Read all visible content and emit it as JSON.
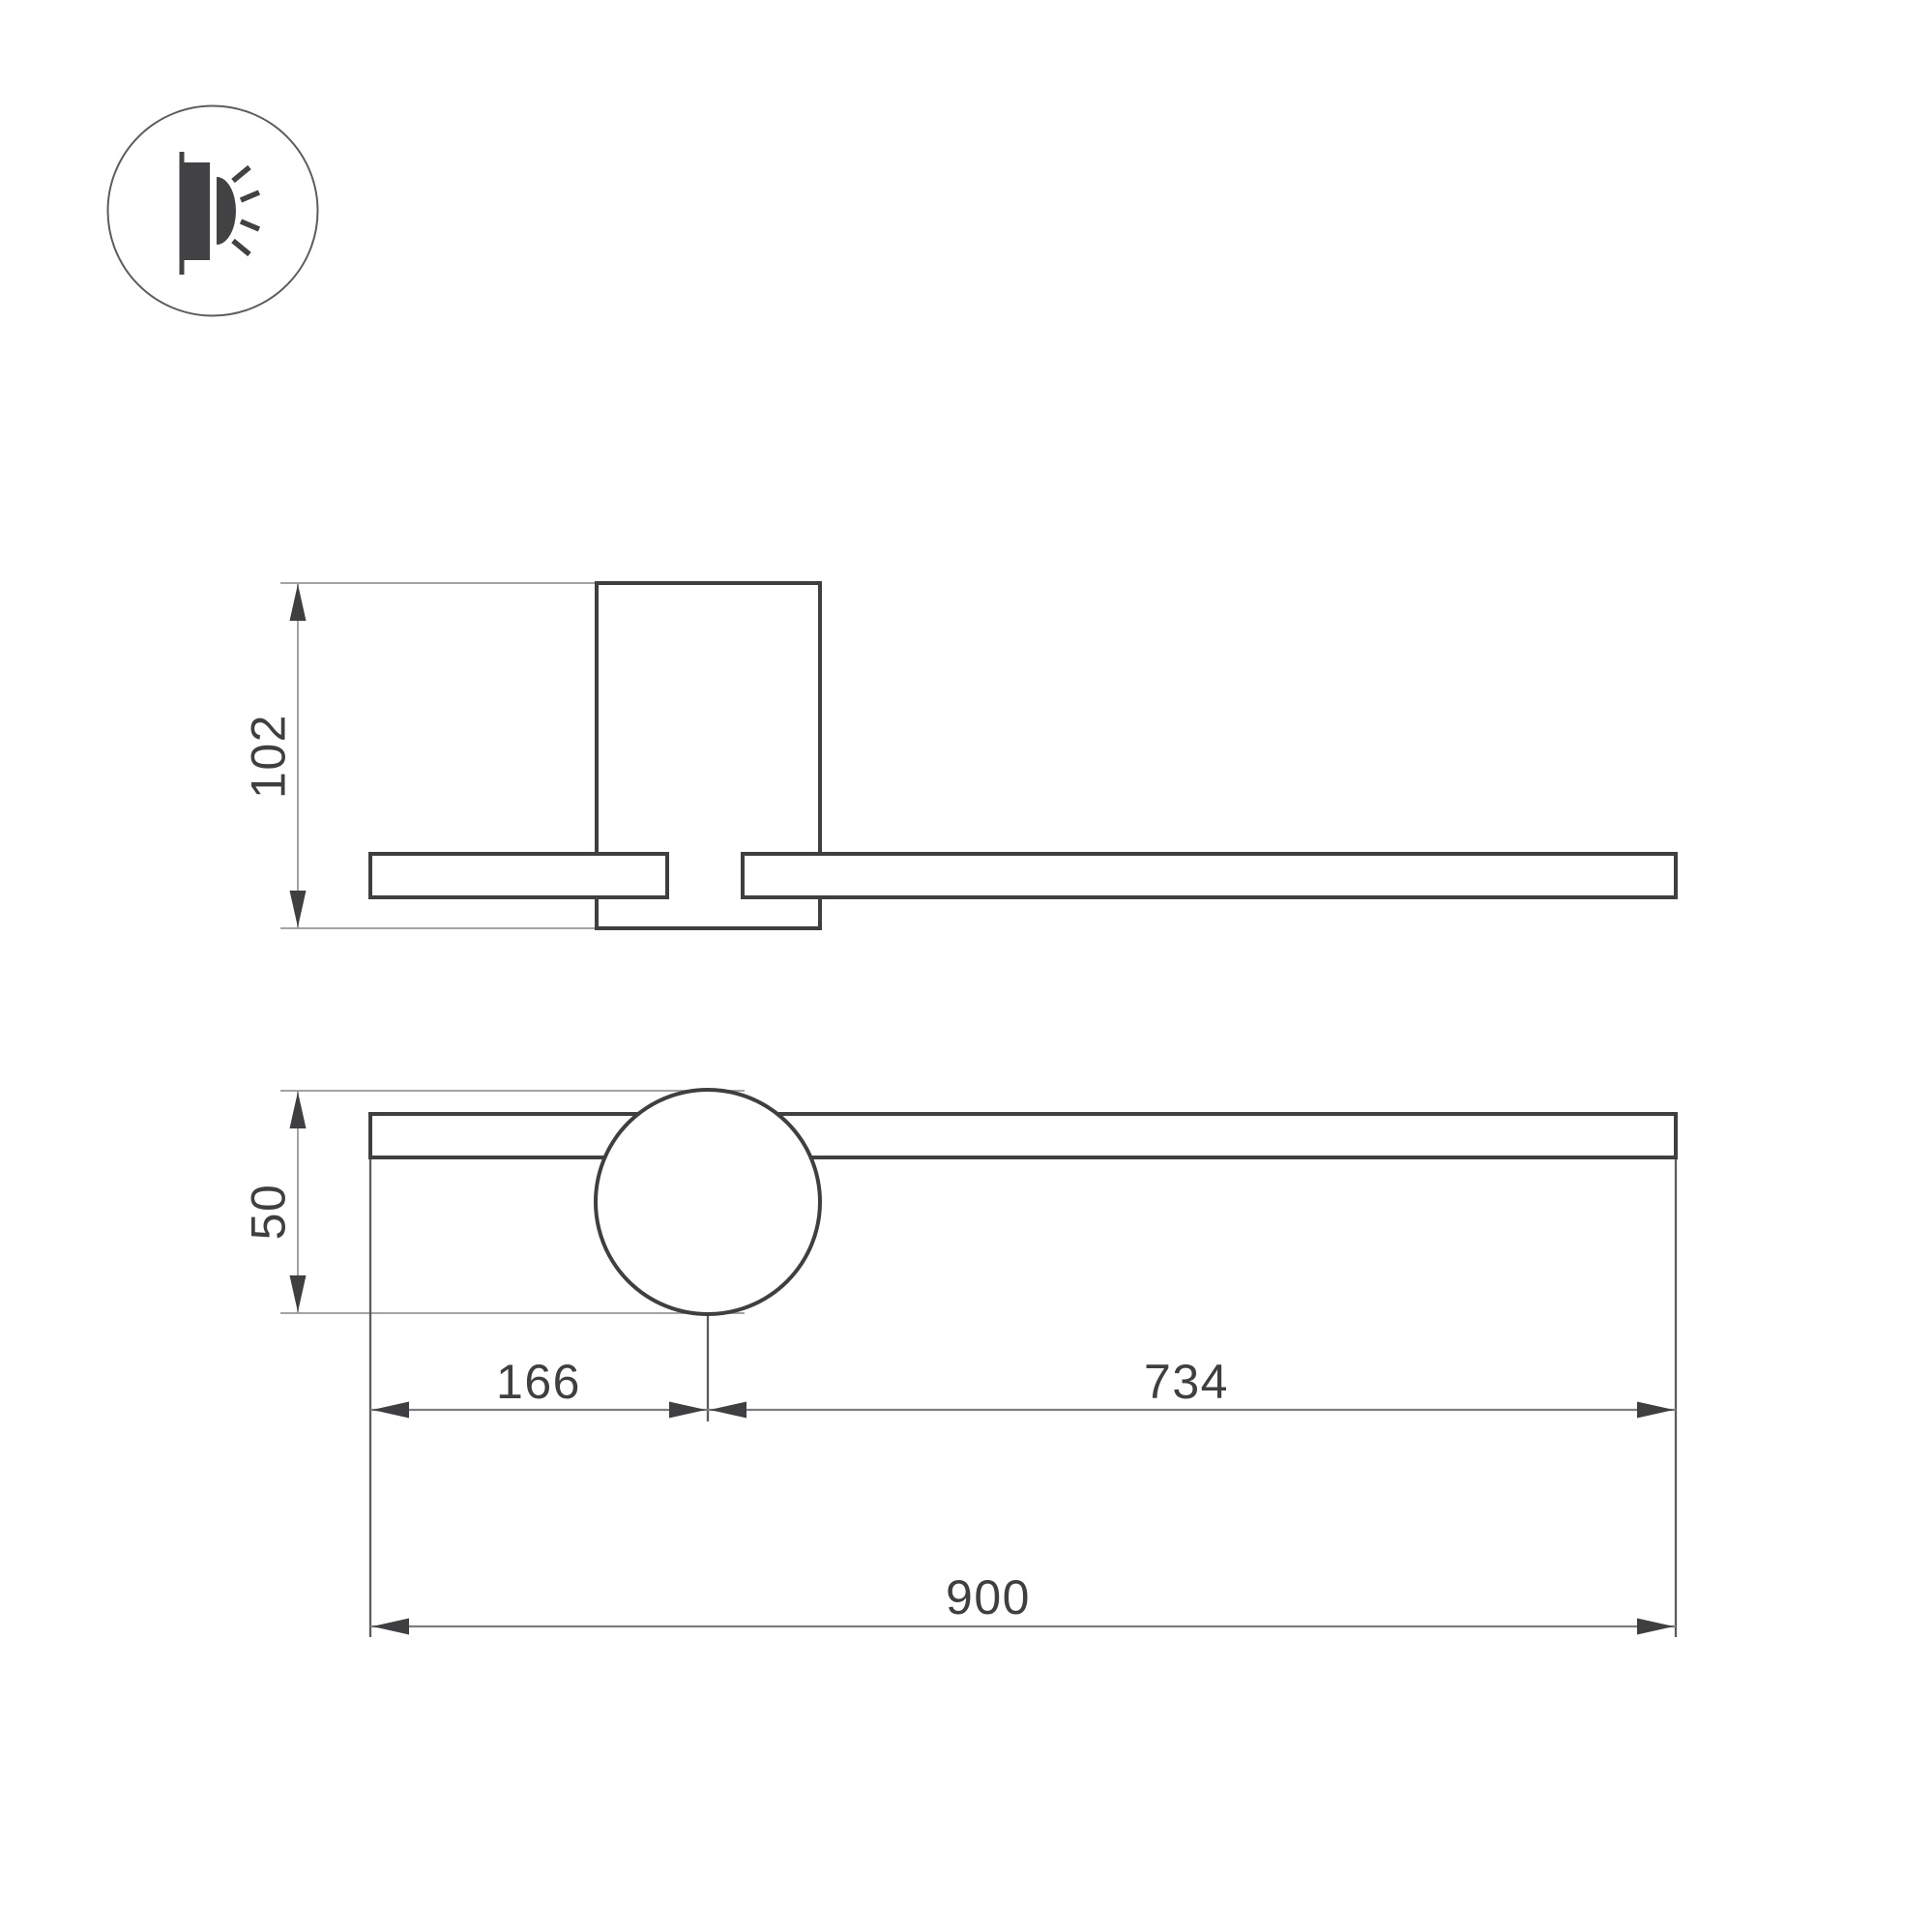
{
  "icon": {
    "type": "wall-mounted-light-indicator"
  },
  "colors": {
    "background": "#ffffff",
    "outline": "#3f3f41",
    "dim_light": "#97979a",
    "dim_mid": "#7e7e81",
    "ext_dark": "#5c5c5f",
    "text": "#3f3f41",
    "icon_fill": "#424245"
  },
  "dimensions": {
    "side_height": "102",
    "head_diameter": "50",
    "left_segment": "166",
    "right_segment": "734",
    "total_length": "900"
  }
}
